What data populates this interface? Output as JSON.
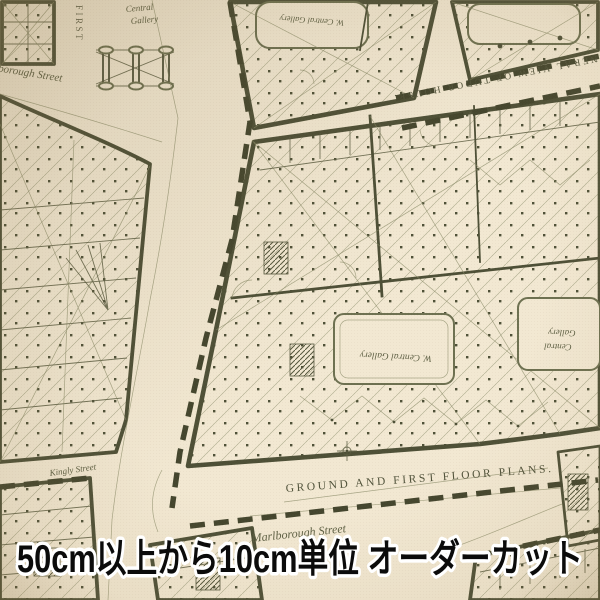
{
  "caption": {
    "text": "50cm以上から10cm単位 オーダーカット"
  },
  "map_labels": {
    "first_floor": "FIRST",
    "marlborough_street_top": "Marlborough Street",
    "central_gallery_top_line1": "Central",
    "central_gallery_top_line2": "Gallery",
    "w_central_gallery_top": "W. Central Gallery",
    "tudor_house_caption": "GENERAL VIEW OF TUDOR HOUSE.",
    "w_central_gallery_mid": "W. Central Gallery",
    "central_gallery_right_line1": "Central",
    "central_gallery_right_line2": "Gallery",
    "kingly_street": "Kingly Street",
    "plans_caption": "GROUND AND FIRST FLOOR PLANS.",
    "marlborough_street_bottom": "Marlborough Street"
  },
  "colors": {
    "fabric_cream": "#f2e8d2",
    "plan_ink": "#4e5037",
    "plan_ink_light": "#8d8f6d",
    "hall_outline_green": "#6d7050",
    "caption_text": "#0b0b0b",
    "caption_outline": "#ffffff"
  }
}
